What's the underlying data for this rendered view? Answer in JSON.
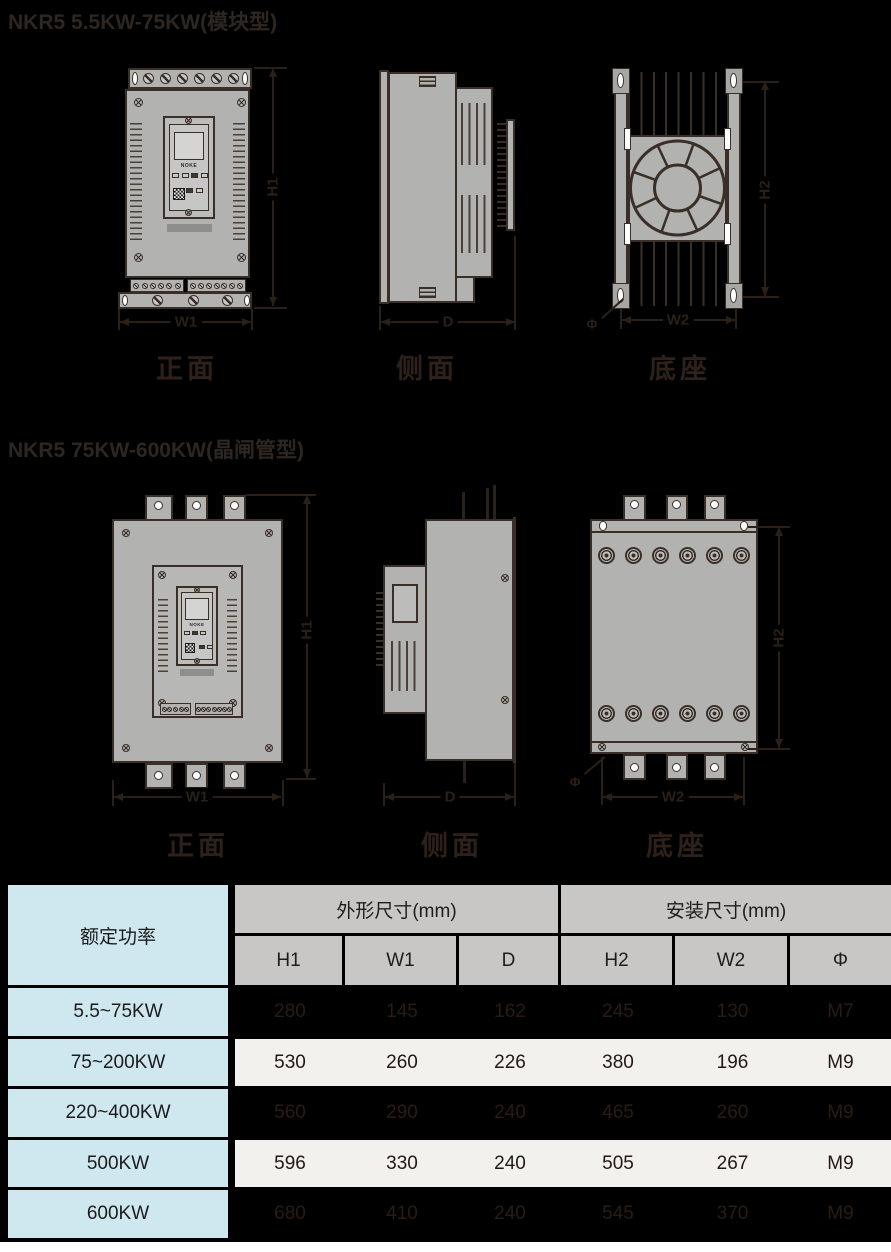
{
  "colors": {
    "page_background": "#000000",
    "metal_gray": "#b2b2b1",
    "outline": "#3a2f28",
    "table_blue": "#cfe7ef",
    "table_header_gray": "#c8c7c5",
    "table_row_white": "#f2f1ee",
    "ink": "#231815"
  },
  "sections": [
    {
      "title": "NKR5  5.5KW-75KW(模块型)",
      "views": [
        {
          "caption": "正面"
        },
        {
          "caption": "侧面"
        },
        {
          "caption": "底座"
        }
      ]
    },
    {
      "title": "NKR5  75KW-600KW(晶闸管型)",
      "views": [
        {
          "caption": "正面"
        },
        {
          "caption": "侧面"
        },
        {
          "caption": "底座"
        }
      ]
    }
  ],
  "dims": {
    "h1": "H1",
    "w1": "W1",
    "d": "D",
    "h2": "H2",
    "w2": "W2",
    "phi": "Φ"
  },
  "device": {
    "brand": "NOKE"
  },
  "table": {
    "power_header": "额定功率",
    "groups": [
      {
        "label": "外形尺寸(mm)"
      },
      {
        "label": "安装尺寸(mm)"
      }
    ],
    "columns": [
      "H1",
      "W1",
      "D",
      "H2",
      "W2",
      "Φ"
    ],
    "rows": [
      {
        "power": "5.5~75KW",
        "values": [
          "280",
          "145",
          "162",
          "245",
          "130",
          "M7"
        ]
      },
      {
        "power": "75~200KW",
        "values": [
          "530",
          "260",
          "226",
          "380",
          "196",
          "M9"
        ]
      },
      {
        "power": "220~400KW",
        "values": [
          "560",
          "290",
          "240",
          "465",
          "260",
          "M9"
        ]
      },
      {
        "power": "500KW",
        "values": [
          "596",
          "330",
          "240",
          "505",
          "267",
          "M9"
        ]
      },
      {
        "power": "600KW",
        "values": [
          "680",
          "410",
          "240",
          "545",
          "370",
          "M9"
        ]
      }
    ]
  }
}
